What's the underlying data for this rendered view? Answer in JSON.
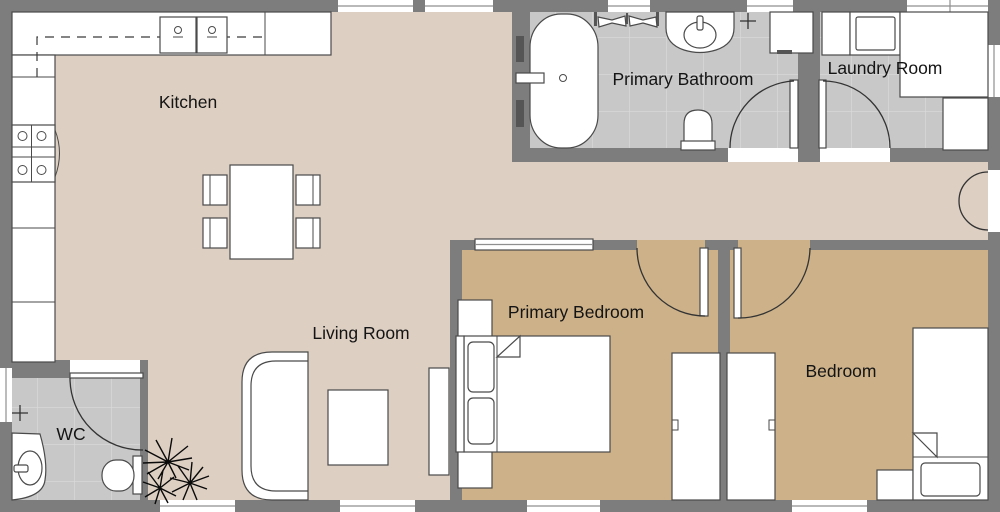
{
  "plan": {
    "rooms": {
      "kitchen": {
        "label": "Kitchen"
      },
      "primary_bathroom": {
        "label": "Primary Bathroom"
      },
      "laundry_room": {
        "label": "Laundry Room"
      },
      "living_room": {
        "label": "Living Room"
      },
      "primary_bedroom": {
        "label": "Primary Bedroom"
      },
      "bedroom": {
        "label": "Bedroom"
      },
      "wc": {
        "label": "WC"
      }
    },
    "colors": {
      "wall": "#7d7d7d",
      "floor_main": "#ddcfc2",
      "floor_bedroom": "#ccb189",
      "floor_tile": "#c8c8c8",
      "tile_grout": "#d9d9d9",
      "furniture_fill": "#ffffff",
      "outline": "#4a4a4a",
      "label_text": "#141414"
    }
  }
}
